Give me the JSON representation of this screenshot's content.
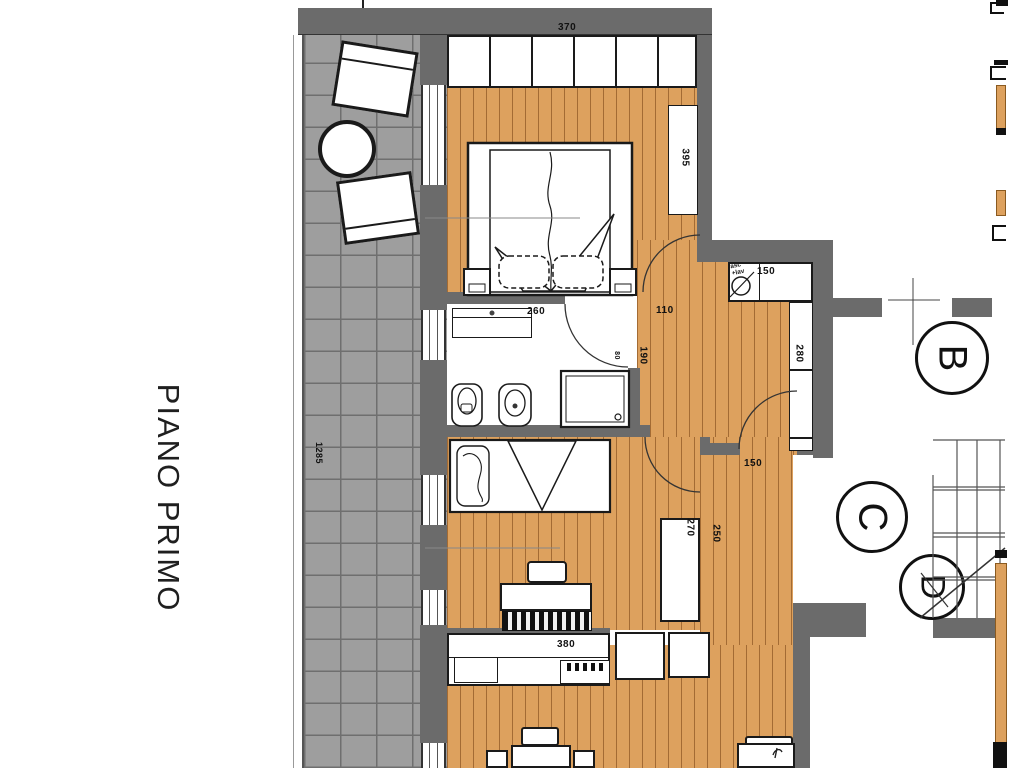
{
  "title": {
    "floor_label": "PIANO PRIMO"
  },
  "colors": {
    "wood": "#dda15e",
    "tile": "#9e9e9e",
    "wall": "#6b6b6b",
    "line": "#1a1a1a"
  },
  "dimensions": {
    "wardrobe_row": "370",
    "bedroom1_depth": "395",
    "terrace_length": "1285",
    "vanity": "260",
    "hall_node": "110",
    "hall_width": "190",
    "bath_door": "80",
    "entry_closet": "150",
    "hall_closet": "280",
    "corridor_door": "150",
    "wardrobe2": "270",
    "corridor": "250",
    "kitchen": "380"
  },
  "stairwell": {
    "label_b": "B",
    "label_c": "C",
    "label_d": "D"
  },
  "laundry": {
    "line1": "asc",
    "line2": "+lav"
  }
}
